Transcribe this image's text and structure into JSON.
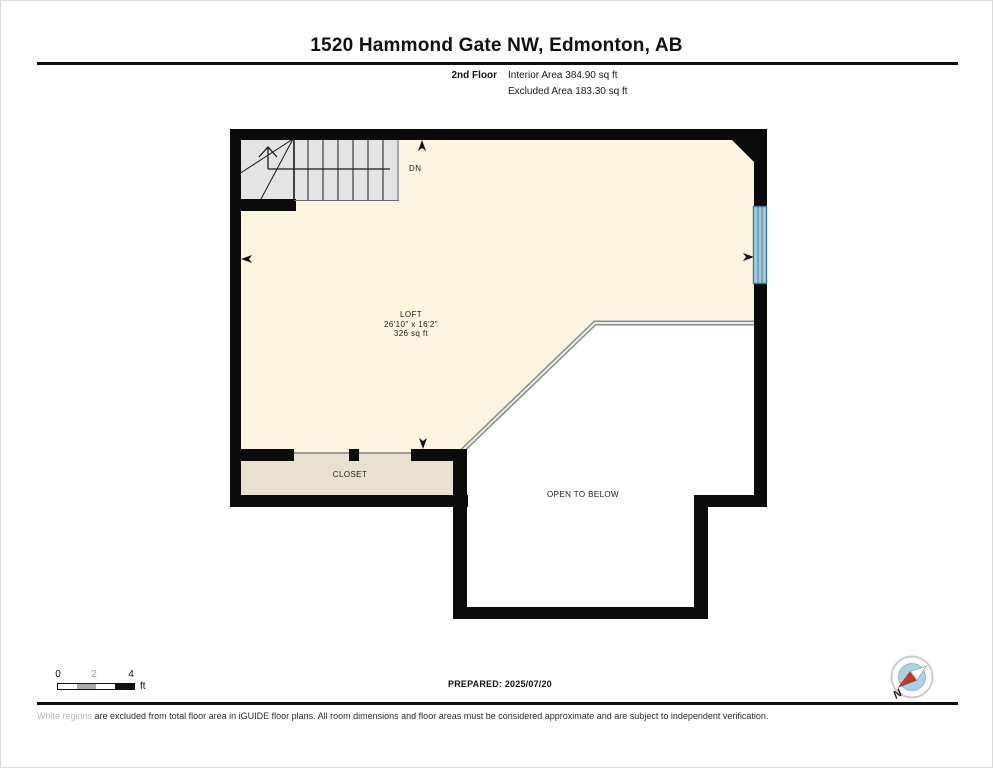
{
  "header": {
    "title": "1520 Hammond Gate NW, Edmonton, AB",
    "floor_label": "2nd Floor",
    "interior_area": "Interior Area 384.90 sq ft",
    "excluded_area": "Excluded Area 183.30 sq ft"
  },
  "plan": {
    "rooms": [
      {
        "name": "LOFT",
        "dimensions": "26'10\" x 16'2\"",
        "area": "326 sq ft"
      },
      {
        "name": "CLOSET"
      },
      {
        "name": "OPEN TO BELOW"
      }
    ],
    "stair_direction_label": "DN",
    "colors": {
      "loft_fill": "#FBF4DE",
      "closet_fill": "#E9E1D0",
      "stairs_fill": "#E4E4E4",
      "window_fill": "#A6CBE0",
      "window_frame": "#44799F",
      "wall": "#0B0B0B",
      "railing": "#8C8C8C"
    }
  },
  "footer": {
    "scale": {
      "tick_start": "0",
      "tick_mid": "2",
      "tick_end": "4",
      "unit": "ft"
    },
    "prepared": "PREPARED: 2025/07/20",
    "disclaimer_start": "White regions ",
    "disclaimer_rest": "are excluded from total floor area in iGUIDE floor plans. All room dimensions and floor areas must be considered approximate and are subject to independent verification.",
    "compass_label": "N"
  }
}
